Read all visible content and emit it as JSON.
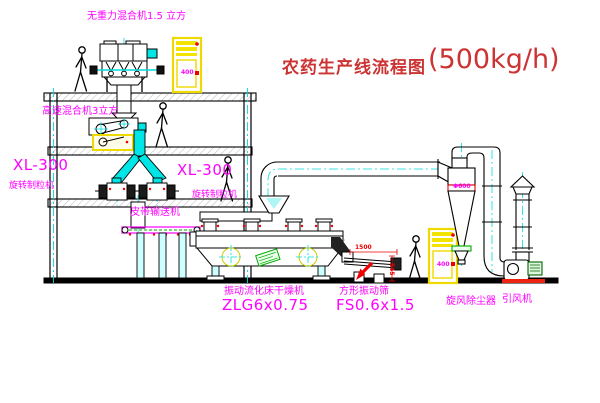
{
  "title": {
    "text": "农药生产线流程图",
    "capacity": "(500kg/h)"
  },
  "labels": {
    "gravity_mixer": "无重力混合机1.5 立方",
    "high_speed_mixer": "高速混合机3立方",
    "granulator_left_model": "XL-300",
    "granulator_left_name": "旋转制粒机",
    "granulator_right_model": "XL-300",
    "granulator_right_name": "旋转制粒机",
    "belt_conveyor": "皮带输送机",
    "fluid_bed_dryer_name": "振动流化床干燥机",
    "fluid_bed_dryer_model": "ZLG6x0.75",
    "vibrating_screen_name": "方形振动筛",
    "vibrating_screen_model": "FS0.6x1.5",
    "cyclone_dust_collector": "旋风除尘器",
    "induced_draft_fan": "引风机"
  },
  "dims": {
    "screen_length": "1500",
    "screen_height": "545",
    "cyclone_diameter": "Φ600"
  },
  "cabinets": {
    "top_mark": "400",
    "bottom_mark": "400"
  },
  "colors": {
    "label": "#ff00ff",
    "title": "#cc3333",
    "dimension": "#ee0000",
    "centerline": "#00dcdc",
    "cabinet": "#eed900",
    "line": "#000000",
    "background": "#ffffff"
  }
}
